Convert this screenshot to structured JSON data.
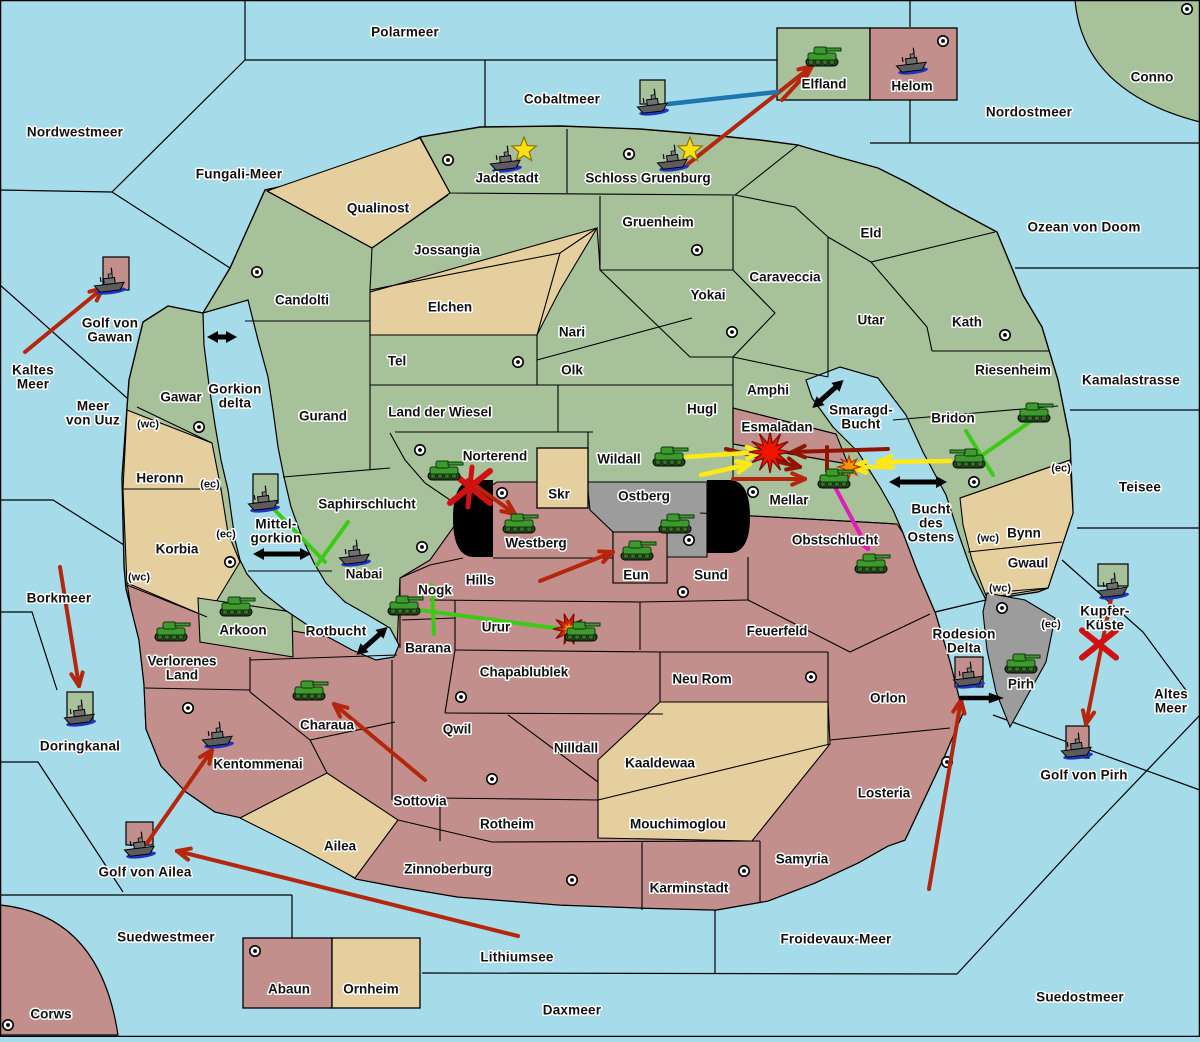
{
  "map": {
    "width": 1200,
    "height": 1037,
    "title": "Fantasy diplomacy war map"
  },
  "colors": {
    "sea": "#a6dbea",
    "green": "#a7c29b",
    "tan": "#e6cf9f",
    "pink": "#c28f8c",
    "gray": "#9c9c9c",
    "border": "#000000",
    "pill": "#000000",
    "label": "#111111",
    "halo": "#ffffff",
    "arrow_red": "#b5270d",
    "arrow_dark_red": "#8f1500",
    "arrow_yellow": "#ffe815",
    "arrow_green": "#3bcb16",
    "arrow_magenta": "#de1eb7",
    "arrow_blue": "#1d76ad",
    "arrow_black": "#000000",
    "star": "#ffe012",
    "explosion_red": "#ee1500",
    "explosion_orange": "#ff9500",
    "tank": "#3f9a2e",
    "ship": "#5c5c5c",
    "ship_wake": "#1f35c0"
  },
  "sea_labels": [
    {
      "text": "Polarmeer",
      "x": 405,
      "y": 32
    },
    {
      "text": "Nordwestmeer",
      "x": 75,
      "y": 132
    },
    {
      "text": "Fungali-Meer",
      "x": 239,
      "y": 174
    },
    {
      "text": "Cobaltmeer",
      "x": 562,
      "y": 99
    },
    {
      "text": "Nordostmeer",
      "x": 1029,
      "y": 112
    },
    {
      "text": "Ozean von Doom",
      "x": 1084,
      "y": 227
    },
    {
      "text": "Golf von\nGawan",
      "x": 110,
      "y": 330
    },
    {
      "text": "Kaltes\nMeer",
      "x": 33,
      "y": 377
    },
    {
      "text": "Meer\nvon Uuz",
      "x": 93,
      "y": 413
    },
    {
      "text": "Gorkion\ndelta",
      "x": 235,
      "y": 396
    },
    {
      "text": "Kamalastrasse",
      "x": 1131,
      "y": 380
    },
    {
      "text": "Teisee",
      "x": 1140,
      "y": 487
    },
    {
      "text": "Smaragd-\nBucht",
      "x": 861,
      "y": 417
    },
    {
      "text": "Bucht\ndes\nOstens",
      "x": 931,
      "y": 523
    },
    {
      "text": "Mittel-\ngorkion",
      "x": 276,
      "y": 531
    },
    {
      "text": "Borkmeer",
      "x": 59,
      "y": 598
    },
    {
      "text": "Rotbucht",
      "x": 336,
      "y": 631
    },
    {
      "text": "Doringkanal",
      "x": 80,
      "y": 746
    },
    {
      "text": "Golf von Ailea",
      "x": 145,
      "y": 872
    },
    {
      "text": "Rodesion\nDelta",
      "x": 964,
      "y": 641
    },
    {
      "text": "Kupfer-\nKüste",
      "x": 1105,
      "y": 618
    },
    {
      "text": "Altes\nMeer",
      "x": 1171,
      "y": 701
    },
    {
      "text": "Golf von Pirh",
      "x": 1084,
      "y": 775
    },
    {
      "text": "Suedwestmeer",
      "x": 166,
      "y": 937
    },
    {
      "text": "Lithiumsee",
      "x": 517,
      "y": 957
    },
    {
      "text": "Daxmeer",
      "x": 572,
      "y": 1010
    },
    {
      "text": "Froidevaux-Meer",
      "x": 836,
      "y": 939
    },
    {
      "text": "Suedostmeer",
      "x": 1080,
      "y": 997
    }
  ],
  "province_labels": [
    {
      "text": "Qualinost",
      "x": 378,
      "y": 208
    },
    {
      "text": "Jadestadt",
      "x": 507,
      "y": 178
    },
    {
      "text": "Schloss Gruenburg",
      "x": 648,
      "y": 178
    },
    {
      "text": "Gruenheim",
      "x": 658,
      "y": 222
    },
    {
      "text": "Jossangia",
      "x": 447,
      "y": 250
    },
    {
      "text": "Candolti",
      "x": 302,
      "y": 300
    },
    {
      "text": "Elchen",
      "x": 450,
      "y": 307
    },
    {
      "text": "Caraveccia",
      "x": 785,
      "y": 277
    },
    {
      "text": "Yokai",
      "x": 708,
      "y": 295
    },
    {
      "text": "Eld",
      "x": 871,
      "y": 233
    },
    {
      "text": "Utar",
      "x": 871,
      "y": 320
    },
    {
      "text": "Kath",
      "x": 967,
      "y": 322
    },
    {
      "text": "Nari",
      "x": 572,
      "y": 332
    },
    {
      "text": "Tel",
      "x": 397,
      "y": 361
    },
    {
      "text": "Olk",
      "x": 572,
      "y": 370
    },
    {
      "text": "Riesenheim",
      "x": 1013,
      "y": 370
    },
    {
      "text": "Land der Wiesel",
      "x": 440,
      "y": 412
    },
    {
      "text": "Hugl",
      "x": 702,
      "y": 409
    },
    {
      "text": "Amphi",
      "x": 768,
      "y": 390
    },
    {
      "text": "Gurand",
      "x": 323,
      "y": 416
    },
    {
      "text": "Gawar",
      "x": 181,
      "y": 397
    },
    {
      "text": "Esmaladan",
      "x": 777,
      "y": 427
    },
    {
      "text": "Bridon",
      "x": 953,
      "y": 418
    },
    {
      "text": "Norterend",
      "x": 495,
      "y": 456
    },
    {
      "text": "Wildall",
      "x": 619,
      "y": 459
    },
    {
      "text": "Skr",
      "x": 559,
      "y": 494
    },
    {
      "text": "Ostberg",
      "x": 644,
      "y": 496
    },
    {
      "text": "Saphirschlucht",
      "x": 367,
      "y": 504
    },
    {
      "text": "Mellar",
      "x": 789,
      "y": 500
    },
    {
      "text": "Heronn",
      "x": 160,
      "y": 478
    },
    {
      "text": "Korbia",
      "x": 177,
      "y": 549
    },
    {
      "text": "Westberg",
      "x": 536,
      "y": 543
    },
    {
      "text": "Bynn",
      "x": 1024,
      "y": 533
    },
    {
      "text": "Gwaul",
      "x": 1028,
      "y": 563
    },
    {
      "text": "Hills",
      "x": 480,
      "y": 580
    },
    {
      "text": "Eun",
      "x": 636,
      "y": 575
    },
    {
      "text": "Sund",
      "x": 711,
      "y": 575
    },
    {
      "text": "Obstschlucht",
      "x": 835,
      "y": 540
    },
    {
      "text": "Nabai",
      "x": 364,
      "y": 574
    },
    {
      "text": "Nogk",
      "x": 435,
      "y": 590
    },
    {
      "text": "Arkoon",
      "x": 243,
      "y": 630
    },
    {
      "text": "Urur",
      "x": 496,
      "y": 627
    },
    {
      "text": "Barana",
      "x": 428,
      "y": 648
    },
    {
      "text": "Verlorenes\nLand",
      "x": 182,
      "y": 668
    },
    {
      "text": "Feuerfeld",
      "x": 777,
      "y": 631
    },
    {
      "text": "Chapablublek",
      "x": 524,
      "y": 672
    },
    {
      "text": "Neu Rom",
      "x": 702,
      "y": 679
    },
    {
      "text": "Charaua",
      "x": 327,
      "y": 725
    },
    {
      "text": "Qwil",
      "x": 457,
      "y": 729
    },
    {
      "text": "Orlon",
      "x": 888,
      "y": 698
    },
    {
      "text": "Nilldall",
      "x": 576,
      "y": 748
    },
    {
      "text": "Kaaldewaa",
      "x": 660,
      "y": 763
    },
    {
      "text": "Kentommenai",
      "x": 258,
      "y": 764
    },
    {
      "text": "Sottovia",
      "x": 420,
      "y": 801
    },
    {
      "text": "Rotheim",
      "x": 507,
      "y": 824
    },
    {
      "text": "Ailea",
      "x": 340,
      "y": 846
    },
    {
      "text": "Losteria",
      "x": 884,
      "y": 793
    },
    {
      "text": "Mouchimoglou",
      "x": 678,
      "y": 824
    },
    {
      "text": "Zinnoberburg",
      "x": 448,
      "y": 869
    },
    {
      "text": "Karminstadt",
      "x": 689,
      "y": 888
    },
    {
      "text": "Samyria",
      "x": 802,
      "y": 859
    },
    {
      "text": "Abaun",
      "x": 289,
      "y": 989
    },
    {
      "text": "Ornheim",
      "x": 371,
      "y": 989
    },
    {
      "text": "Corws",
      "x": 51,
      "y": 1014
    },
    {
      "text": "Pirh",
      "x": 1021,
      "y": 684
    },
    {
      "text": "Elfland",
      "x": 824,
      "y": 84
    },
    {
      "text": "Helom",
      "x": 912,
      "y": 86
    },
    {
      "text": "Conno",
      "x": 1152,
      "y": 77
    }
  ],
  "coast_markers": [
    {
      "text": "(wc)",
      "x": 148,
      "y": 423
    },
    {
      "text": "(ec)",
      "x": 210,
      "y": 483
    },
    {
      "text": "(ec)",
      "x": 226,
      "y": 533
    },
    {
      "text": "(wc)",
      "x": 139,
      "y": 576
    },
    {
      "text": "(ec)",
      "x": 1061,
      "y": 467
    },
    {
      "text": "(wc)",
      "x": 988,
      "y": 537
    },
    {
      "text": "(wc)",
      "x": 1000,
      "y": 587
    },
    {
      "text": "(ec)",
      "x": 1051,
      "y": 623
    }
  ],
  "supply_centers": [
    [
      257,
      272
    ],
    [
      448,
      160
    ],
    [
      629,
      154
    ],
    [
      943,
      41
    ],
    [
      1187,
      9
    ],
    [
      697,
      250
    ],
    [
      732,
      332
    ],
    [
      1005,
      335
    ],
    [
      199,
      427
    ],
    [
      518,
      362
    ],
    [
      420,
      450
    ],
    [
      502,
      493
    ],
    [
      422,
      547
    ],
    [
      753,
      492
    ],
    [
      974,
      482
    ],
    [
      683,
      592
    ],
    [
      689,
      540
    ],
    [
      461,
      697
    ],
    [
      492,
      779
    ],
    [
      188,
      708
    ],
    [
      811,
      677
    ],
    [
      947,
      762
    ],
    [
      744,
      871
    ],
    [
      572,
      880
    ],
    [
      255,
      951
    ],
    [
      8,
      1025
    ],
    [
      1002,
      608
    ],
    [
      230,
      562
    ]
  ],
  "unit_boxes": [
    {
      "name": "golf-von-gawan-box",
      "x": 103,
      "y": 257,
      "w": 26,
      "h": 33,
      "color": "pink"
    },
    {
      "name": "cobaltmeer-box",
      "x": 640,
      "y": 80,
      "w": 25,
      "h": 24,
      "color": "green"
    },
    {
      "name": "mittelgorkion-box",
      "x": 253,
      "y": 474,
      "w": 25,
      "h": 29,
      "color": "green"
    },
    {
      "name": "doringkanal-box",
      "x": 67,
      "y": 692,
      "w": 26,
      "h": 29,
      "color": "green"
    },
    {
      "name": "golf-von-ailea-box",
      "x": 126,
      "y": 822,
      "w": 27,
      "h": 23,
      "color": "pink"
    },
    {
      "name": "rodesion-delta-box",
      "x": 955,
      "y": 657,
      "w": 28,
      "h": 30,
      "color": "pink"
    },
    {
      "name": "kupfer-kueste-box",
      "x": 1098,
      "y": 564,
      "w": 30,
      "h": 22,
      "color": "green"
    },
    {
      "name": "golf-von-pirh-box",
      "x": 1066,
      "y": 726,
      "w": 23,
      "h": 32,
      "color": "pink"
    }
  ],
  "units": [
    {
      "type": "tank",
      "name": "tank-elfland",
      "x": 822,
      "y": 57,
      "flip": false
    },
    {
      "type": "tank",
      "name": "tank-norterend",
      "x": 444,
      "y": 471,
      "flip": false
    },
    {
      "type": "tank",
      "name": "tank-westberg",
      "x": 519,
      "y": 524,
      "flip": false
    },
    {
      "type": "tank",
      "name": "tank-wildall",
      "x": 669,
      "y": 457,
      "flip": false
    },
    {
      "type": "tank",
      "name": "tank-ostberg",
      "x": 675,
      "y": 524,
      "flip": false
    },
    {
      "type": "tank",
      "name": "tank-eun",
      "x": 637,
      "y": 551,
      "flip": false
    },
    {
      "type": "tank",
      "name": "tank-mellar",
      "x": 834,
      "y": 479,
      "flip": false
    },
    {
      "type": "tank",
      "name": "tank-obstschlucht",
      "x": 871,
      "y": 564,
      "flip": false
    },
    {
      "type": "tank",
      "name": "tank-bridon",
      "x": 969,
      "y": 459,
      "flip": true
    },
    {
      "type": "tank",
      "name": "tank-riesenheim",
      "x": 1034,
      "y": 413,
      "flip": false
    },
    {
      "type": "tank",
      "name": "tank-nogk",
      "x": 404,
      "y": 606,
      "flip": false
    },
    {
      "type": "tank",
      "name": "tank-urur",
      "x": 581,
      "y": 632,
      "flip": false
    },
    {
      "type": "tank",
      "name": "tank-arkoon",
      "x": 236,
      "y": 607,
      "flip": false
    },
    {
      "type": "tank",
      "name": "tank-verlorenes-land",
      "x": 171,
      "y": 632,
      "flip": false
    },
    {
      "type": "tank",
      "name": "tank-charaua",
      "x": 309,
      "y": 691,
      "flip": false
    },
    {
      "type": "tank",
      "name": "tank-pirh",
      "x": 1021,
      "y": 664,
      "flip": false
    },
    {
      "type": "ship",
      "name": "ship-golf-von-gawan",
      "x": 110,
      "y": 282
    },
    {
      "type": "ship",
      "name": "ship-cobaltmeer",
      "x": 653,
      "y": 103
    },
    {
      "type": "ship",
      "name": "ship-helom",
      "x": 912,
      "y": 62
    },
    {
      "type": "ship",
      "name": "ship-jadestadt",
      "x": 506,
      "y": 160
    },
    {
      "type": "ship",
      "name": "ship-schloss-gruenburg",
      "x": 673,
      "y": 159
    },
    {
      "type": "ship",
      "name": "ship-mittelgorkion",
      "x": 264,
      "y": 500
    },
    {
      "type": "ship",
      "name": "ship-nabai",
      "x": 355,
      "y": 554
    },
    {
      "type": "ship",
      "name": "ship-doringkanal",
      "x": 80,
      "y": 714
    },
    {
      "type": "ship",
      "name": "ship-kentommenai",
      "x": 218,
      "y": 736
    },
    {
      "type": "ship",
      "name": "ship-golf-von-ailea",
      "x": 140,
      "y": 846
    },
    {
      "type": "ship",
      "name": "ship-rodesion-delta",
      "x": 969,
      "y": 676
    },
    {
      "type": "ship",
      "name": "ship-kupfer-kueste",
      "x": 1113,
      "y": 587
    },
    {
      "type": "ship",
      "name": "ship-golf-von-pirh",
      "x": 1077,
      "y": 747
    }
  ],
  "stars": [
    [
      524,
      150
    ],
    [
      690,
      150
    ]
  ],
  "explosions": [
    {
      "kind": "big",
      "x": 770,
      "y": 452
    },
    {
      "kind": "small",
      "x": 849,
      "y": 467
    },
    {
      "kind": "medium",
      "x": 569,
      "y": 629
    }
  ],
  "x_marks": [
    {
      "color": "red",
      "x": 470,
      "y": 487,
      "size": 20,
      "strokes": 3
    },
    {
      "color": "red",
      "x": 1099,
      "y": 644,
      "size": 17,
      "strokes": 2
    }
  ],
  "arrows": [
    {
      "c": "red",
      "x1": 25,
      "y1": 352,
      "x2": 103,
      "y2": 288,
      "head": "v"
    },
    {
      "c": "red",
      "x1": 688,
      "y1": 164,
      "x2": 812,
      "y2": 66,
      "head": "v"
    },
    {
      "c": "red",
      "x1": 782,
      "y1": 100,
      "x2": 806,
      "y2": 74,
      "head": null
    },
    {
      "c": "red",
      "x1": 468,
      "y1": 480,
      "x2": 515,
      "y2": 514,
      "head": "v"
    },
    {
      "c": "red",
      "x1": 540,
      "y1": 581,
      "x2": 613,
      "y2": 552,
      "head": "v"
    },
    {
      "c": "dark_red",
      "x1": 888,
      "y1": 449,
      "x2": 792,
      "y2": 452,
      "head": "v"
    },
    {
      "c": "dark_red",
      "x1": 726,
      "y1": 449,
      "x2": 800,
      "y2": 467,
      "head": "v"
    },
    {
      "c": "red",
      "x1": 733,
      "y1": 479,
      "x2": 805,
      "y2": 479,
      "head": "v"
    },
    {
      "c": "dark_red",
      "x1": 827,
      "y1": 447,
      "x2": 827,
      "y2": 471,
      "head": null
    },
    {
      "c": "red",
      "x1": 425,
      "y1": 780,
      "x2": 334,
      "y2": 704,
      "head": "v"
    },
    {
      "c": "red",
      "x1": 60,
      "y1": 567,
      "x2": 79,
      "y2": 686,
      "head": "v"
    },
    {
      "c": "red",
      "x1": 518,
      "y1": 936,
      "x2": 177,
      "y2": 851,
      "head": "v"
    },
    {
      "c": "red",
      "x1": 147,
      "y1": 843,
      "x2": 212,
      "y2": 750,
      "head": "v"
    },
    {
      "c": "red",
      "x1": 929,
      "y1": 889,
      "x2": 961,
      "y2": 700,
      "head": "v"
    },
    {
      "c": "red",
      "x1": 1111,
      "y1": 599,
      "x2": 1086,
      "y2": 724,
      "head": "v"
    },
    {
      "c": "yellow",
      "x1": 686,
      "y1": 457,
      "x2": 760,
      "y2": 452,
      "head": "v"
    },
    {
      "c": "yellow",
      "x1": 701,
      "y1": 475,
      "x2": 750,
      "y2": 464,
      "head": "v"
    },
    {
      "c": "yellow",
      "x1": 950,
      "y1": 461,
      "x2": 878,
      "y2": 462,
      "head": "v"
    },
    {
      "c": "yellow",
      "x1": 893,
      "y1": 467,
      "x2": 853,
      "y2": 467,
      "head": "v"
    },
    {
      "c": "green",
      "x1": 265,
      "y1": 500,
      "x2": 325,
      "y2": 562,
      "head": null
    },
    {
      "c": "green",
      "x1": 348,
      "y1": 522,
      "x2": 317,
      "y2": 565,
      "head": null
    },
    {
      "c": "green",
      "x1": 404,
      "y1": 608,
      "x2": 562,
      "y2": 629,
      "head": null
    },
    {
      "c": "green",
      "x1": 432,
      "y1": 585,
      "x2": 434,
      "y2": 634,
      "head": null
    },
    {
      "c": "green",
      "x1": 1034,
      "y1": 419,
      "x2": 977,
      "y2": 459,
      "head": null
    },
    {
      "c": "green",
      "x1": 966,
      "y1": 431,
      "x2": 993,
      "y2": 475,
      "head": null
    },
    {
      "c": "magenta",
      "x1": 836,
      "y1": 489,
      "x2": 868,
      "y2": 549,
      "head": "v"
    },
    {
      "c": "blue",
      "x1": 668,
      "y1": 104,
      "x2": 777,
      "y2": 92,
      "head": null,
      "w": 4.5
    },
    {
      "c": "black",
      "x1": 961,
      "y1": 698,
      "x2": 996,
      "y2": 698,
      "head": "tri",
      "w": 4.5
    }
  ],
  "double_arrows": [
    {
      "x": 222,
      "y": 337,
      "len": 30,
      "deg": 0
    },
    {
      "x": 282,
      "y": 554,
      "len": 58,
      "deg": 0
    },
    {
      "x": 372,
      "y": 641,
      "len": 42,
      "deg": -42
    },
    {
      "x": 828,
      "y": 394,
      "len": 42,
      "deg": -42
    },
    {
      "x": 918,
      "y": 482,
      "len": 58,
      "deg": 0
    }
  ]
}
